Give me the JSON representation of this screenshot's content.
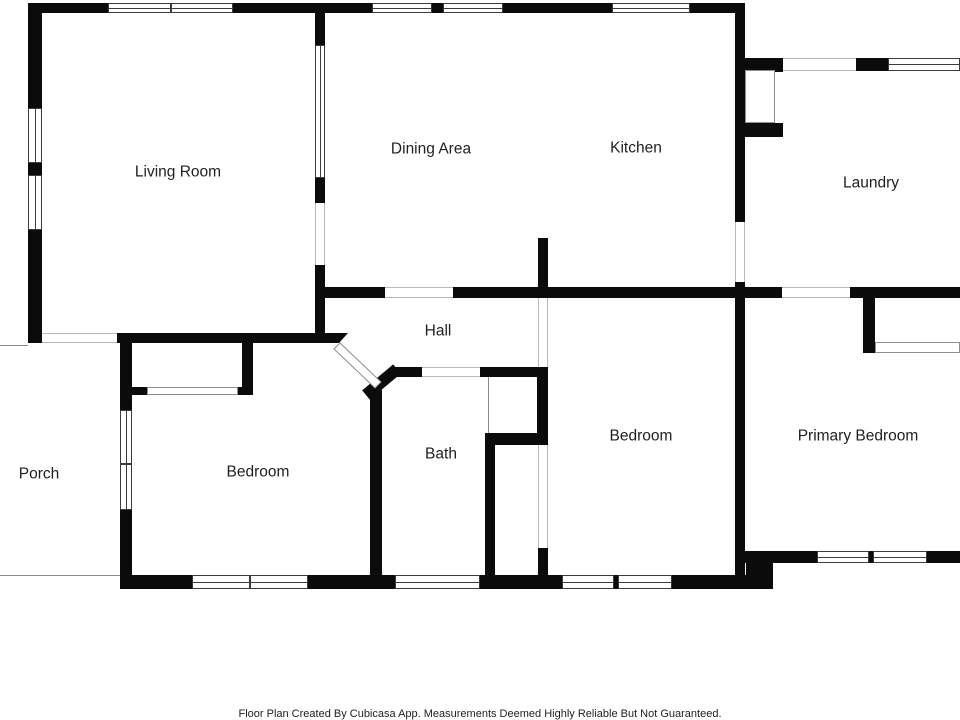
{
  "canvas": {
    "width": 960,
    "height": 720
  },
  "colors": {
    "wall": "#0b0b0b",
    "window_frame": "#3c3c3c",
    "opening_line": "#b9b9b9",
    "panel_line": "#8f8f8f",
    "thin_line": "#8a8a8a",
    "label": "#1f1f1f",
    "background": "#ffffff"
  },
  "rooms": [
    {
      "id": "living-room",
      "label": "Living Room",
      "x": 178,
      "y": 173
    },
    {
      "id": "dining-area",
      "label": "Dining Area",
      "x": 431,
      "y": 150
    },
    {
      "id": "kitchen",
      "label": "Kitchen",
      "x": 636,
      "y": 149
    },
    {
      "id": "laundry",
      "label": "Laundry",
      "x": 871,
      "y": 184
    },
    {
      "id": "hall",
      "label": "Hall",
      "x": 438,
      "y": 332
    },
    {
      "id": "porch",
      "label": "Porch",
      "x": 39,
      "y": 475
    },
    {
      "id": "bedroom-left",
      "label": "Bedroom",
      "x": 258,
      "y": 473
    },
    {
      "id": "bath",
      "label": "Bath",
      "x": 441,
      "y": 455
    },
    {
      "id": "bedroom-middle",
      "label": "Bedroom",
      "x": 641,
      "y": 437
    },
    {
      "id": "primary-bedroom",
      "label": "Primary Bedroom",
      "x": 858,
      "y": 437
    }
  ],
  "footer": {
    "text": "Floor Plan Created By Cubicasa App. Measurements Deemed Highly Reliable But Not Guaranteed.",
    "y": 708
  },
  "geometry": {
    "walls": [
      [
        28,
        3,
        717,
        10
      ],
      [
        28,
        3,
        14,
        340
      ],
      [
        315,
        10,
        10,
        333
      ],
      [
        735,
        3,
        10,
        586
      ],
      [
        325,
        287,
        635,
        11
      ],
      [
        538,
        238,
        10,
        60
      ],
      [
        117,
        333,
        222,
        10
      ],
      [
        120,
        333,
        12,
        77
      ],
      [
        120,
        510,
        12,
        79
      ],
      [
        242,
        343,
        11,
        52
      ],
      [
        132,
        387,
        15,
        8
      ],
      [
        238,
        387,
        15,
        8
      ],
      [
        390,
        367,
        32,
        10
      ],
      [
        370,
        390,
        12,
        199
      ],
      [
        480,
        367,
        68,
        10
      ],
      [
        537,
        367,
        11,
        78
      ],
      [
        485,
        433,
        63,
        12
      ],
      [
        485,
        445,
        10,
        144
      ],
      [
        538,
        548,
        10,
        29
      ],
      [
        120,
        575,
        653,
        14
      ],
      [
        746,
        563,
        27,
        13
      ],
      [
        740,
        551,
        220,
        12
      ],
      [
        745,
        58,
        38,
        14
      ],
      [
        745,
        123,
        38,
        14
      ],
      [
        856,
        58,
        32,
        13
      ],
      [
        863,
        298,
        12,
        55
      ]
    ],
    "diag_walls": [
      [
        366,
        395,
        397,
        369,
        12
      ]
    ],
    "bevels": [
      [
        [
          339,
          333
        ],
        [
          348,
          333
        ],
        [
          339,
          343
        ]
      ]
    ],
    "windows": [
      {
        "r": [
          108,
          3,
          63,
          10
        ],
        "o": "h"
      },
      {
        "r": [
          171,
          3,
          62,
          10
        ],
        "o": "h"
      },
      {
        "r": [
          372,
          3,
          60,
          10
        ],
        "o": "h"
      },
      {
        "r": [
          443,
          3,
          60,
          10
        ],
        "o": "h"
      },
      {
        "r": [
          612,
          3,
          78,
          10
        ],
        "o": "h"
      },
      {
        "r": [
          28,
          108,
          14,
          55
        ],
        "o": "v"
      },
      {
        "r": [
          28,
          175,
          14,
          55
        ],
        "o": "v"
      },
      {
        "r": [
          315,
          45,
          10,
          133
        ],
        "o": "v"
      },
      {
        "r": [
          120,
          410,
          12,
          54
        ],
        "o": "v"
      },
      {
        "r": [
          120,
          464,
          12,
          46
        ],
        "o": "v"
      },
      {
        "r": [
          192,
          575,
          58,
          14
        ],
        "o": "h"
      },
      {
        "r": [
          250,
          575,
          58,
          14
        ],
        "o": "h"
      },
      {
        "r": [
          395,
          575,
          85,
          14
        ],
        "o": "h"
      },
      {
        "r": [
          562,
          575,
          52,
          14
        ],
        "o": "h"
      },
      {
        "r": [
          618,
          575,
          54,
          14
        ],
        "o": "h"
      },
      {
        "r": [
          817,
          551,
          52,
          12
        ],
        "o": "h"
      },
      {
        "r": [
          873,
          551,
          54,
          12
        ],
        "o": "h"
      },
      {
        "r": [
          888,
          58,
          72,
          13
        ],
        "o": "h"
      }
    ],
    "openings": [
      {
        "r": [
          42,
          333,
          75,
          10
        ],
        "o": "h"
      },
      {
        "r": [
          315,
          203,
          10,
          62
        ],
        "o": "v"
      },
      {
        "r": [
          385,
          287,
          68,
          11
        ],
        "o": "h"
      },
      {
        "r": [
          782,
          287,
          68,
          11
        ],
        "o": "h"
      },
      {
        "r": [
          735,
          222,
          10,
          60
        ],
        "o": "v"
      },
      {
        "r": [
          422,
          367,
          58,
          10
        ],
        "o": "h"
      },
      {
        "r": [
          538,
          298,
          10,
          69
        ],
        "o": "v"
      },
      {
        "r": [
          538,
          445,
          10,
          103
        ],
        "o": "v"
      },
      {
        "r": [
          783,
          58,
          73,
          13
        ],
        "o": "h"
      }
    ],
    "panels": [
      [
        147,
        387,
        91,
        8
      ],
      [
        875,
        342,
        85,
        11
      ]
    ],
    "leaves": [
      [
        745,
        70,
        30,
        53
      ]
    ],
    "diag_leaves": [
      [
        [
          334,
          349
        ],
        [
          340,
          343
        ],
        [
          381,
          382
        ],
        [
          375,
          388
        ]
      ]
    ],
    "thin_lines": [
      [
        0,
        345,
        28,
        1
      ],
      [
        0,
        575,
        120,
        1
      ],
      [
        488,
        377,
        1,
        56
      ]
    ]
  }
}
